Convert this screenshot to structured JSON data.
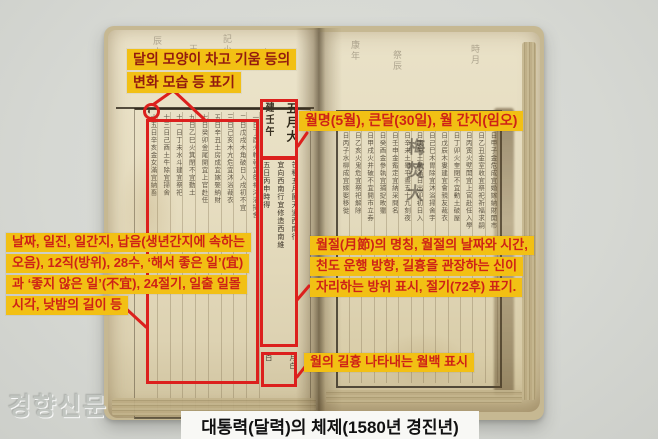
{
  "image": {
    "caption": "대통력(달력)의 체제(1580년 경진년)",
    "watermark": "경향신문"
  },
  "annotations": {
    "moon_phase": {
      "line1": "달의 모양이 차고 기움 등의",
      "line2": "변화 모습 등 표기"
    },
    "month_header": {
      "text": "월명(5월), 큰달(30일), 월 간지(임오)"
    },
    "day_columns": {
      "line1": "날짜, 일진, 일간지, 납음(생년간지에 속하는",
      "line2": "오음), 12직(방위), 28수, ‘해서 좋은 일’(宜)",
      "line3": "과 ‘좋지 않은 일’(不宜), 24절기, 일출 일몰",
      "line4": "시각, 낮밤의 길이 등"
    },
    "month_term": {
      "line1": "월절(月節)의 명칭, 월절의 날짜와 시간,",
      "line2": "천도 운행 방향, 길흉을 관장하는 신이",
      "line3": "자리하는 방위 표시, 절기(72후) 표기."
    },
    "month_luck": {
      "text": "월의 길흉 나타내는 월백 표시"
    }
  },
  "book": {
    "left_page": {
      "moon_symbol": "◐",
      "month_box_columns": [
        "五月大",
        "建壬午"
      ],
      "term_columns": [
        "芒種五月節天道西南行",
        "宜向西南行宜修造西南維",
        "五日丙申時得"
      ],
      "luck_box_columns": [
        "月白",
        "白"
      ],
      "grid_columns": [
        "一日丁酉火軫執宜祭祀沐浴掃舍",
        "二日戊戌木角破日入戌初不宜",
        "三日己亥木亢危宜沐浴裁衣",
        "五日辛丑土房成宜嫁娶納財",
        "七日癸卯金尾開宜上官赴任",
        "九日乙巳火箕閉不宜動土",
        "十一日丁未水斗建宜祭祀",
        "十三日己酉土牛除宜掃舍",
        "十五日辛亥金女滿宜納畜"
      ],
      "top_marks": [
        "辰占",
        "王大",
        "記小",
        "吉月"
      ]
    },
    "right_page": {
      "large_marks": "梅焚大",
      "columns": [
        "十一日甲子金危成宜婚嫁納財開市",
        "十二日乙丑金室收宜祭祀祈福求嗣",
        "十三日丙寅火壁開宜上官赴任入學",
        "十四日丁卯火奎閉不宜動土破屋",
        "十五日戊辰木婁建宜會親友裁衣",
        "十六日己巳木胃除宜沐浴掃舍宇",
        "十七日庚午土昴滿日出卯初日入",
        "十八日辛未土畢平晝五十九刻夜",
        "十九日壬申金觜定宜納采問名",
        "二十日癸酉金參執宜捕捉畋獵",
        "廿一日甲戌火井破不宜開市立券",
        "廿二日乙亥火鬼危宜祭祀解除",
        "廿三日丙子水柳成宜嫁娶移徙"
      ],
      "top_marks": [
        "康年",
        "祭辰",
        "時月"
      ]
    }
  },
  "colors": {
    "accent_red": "#dc201d",
    "highlight_yellow": "#f2c014",
    "annotation_text_red": "#ce2217",
    "annotation_text_dark": "#931a0f",
    "caption_bg": "#f8f8f5",
    "caption_text": "#111111",
    "background_gray": "#d6d8d3",
    "paper_cream": "#e6ddc0",
    "watermark_gray": "#c1c5c0"
  }
}
